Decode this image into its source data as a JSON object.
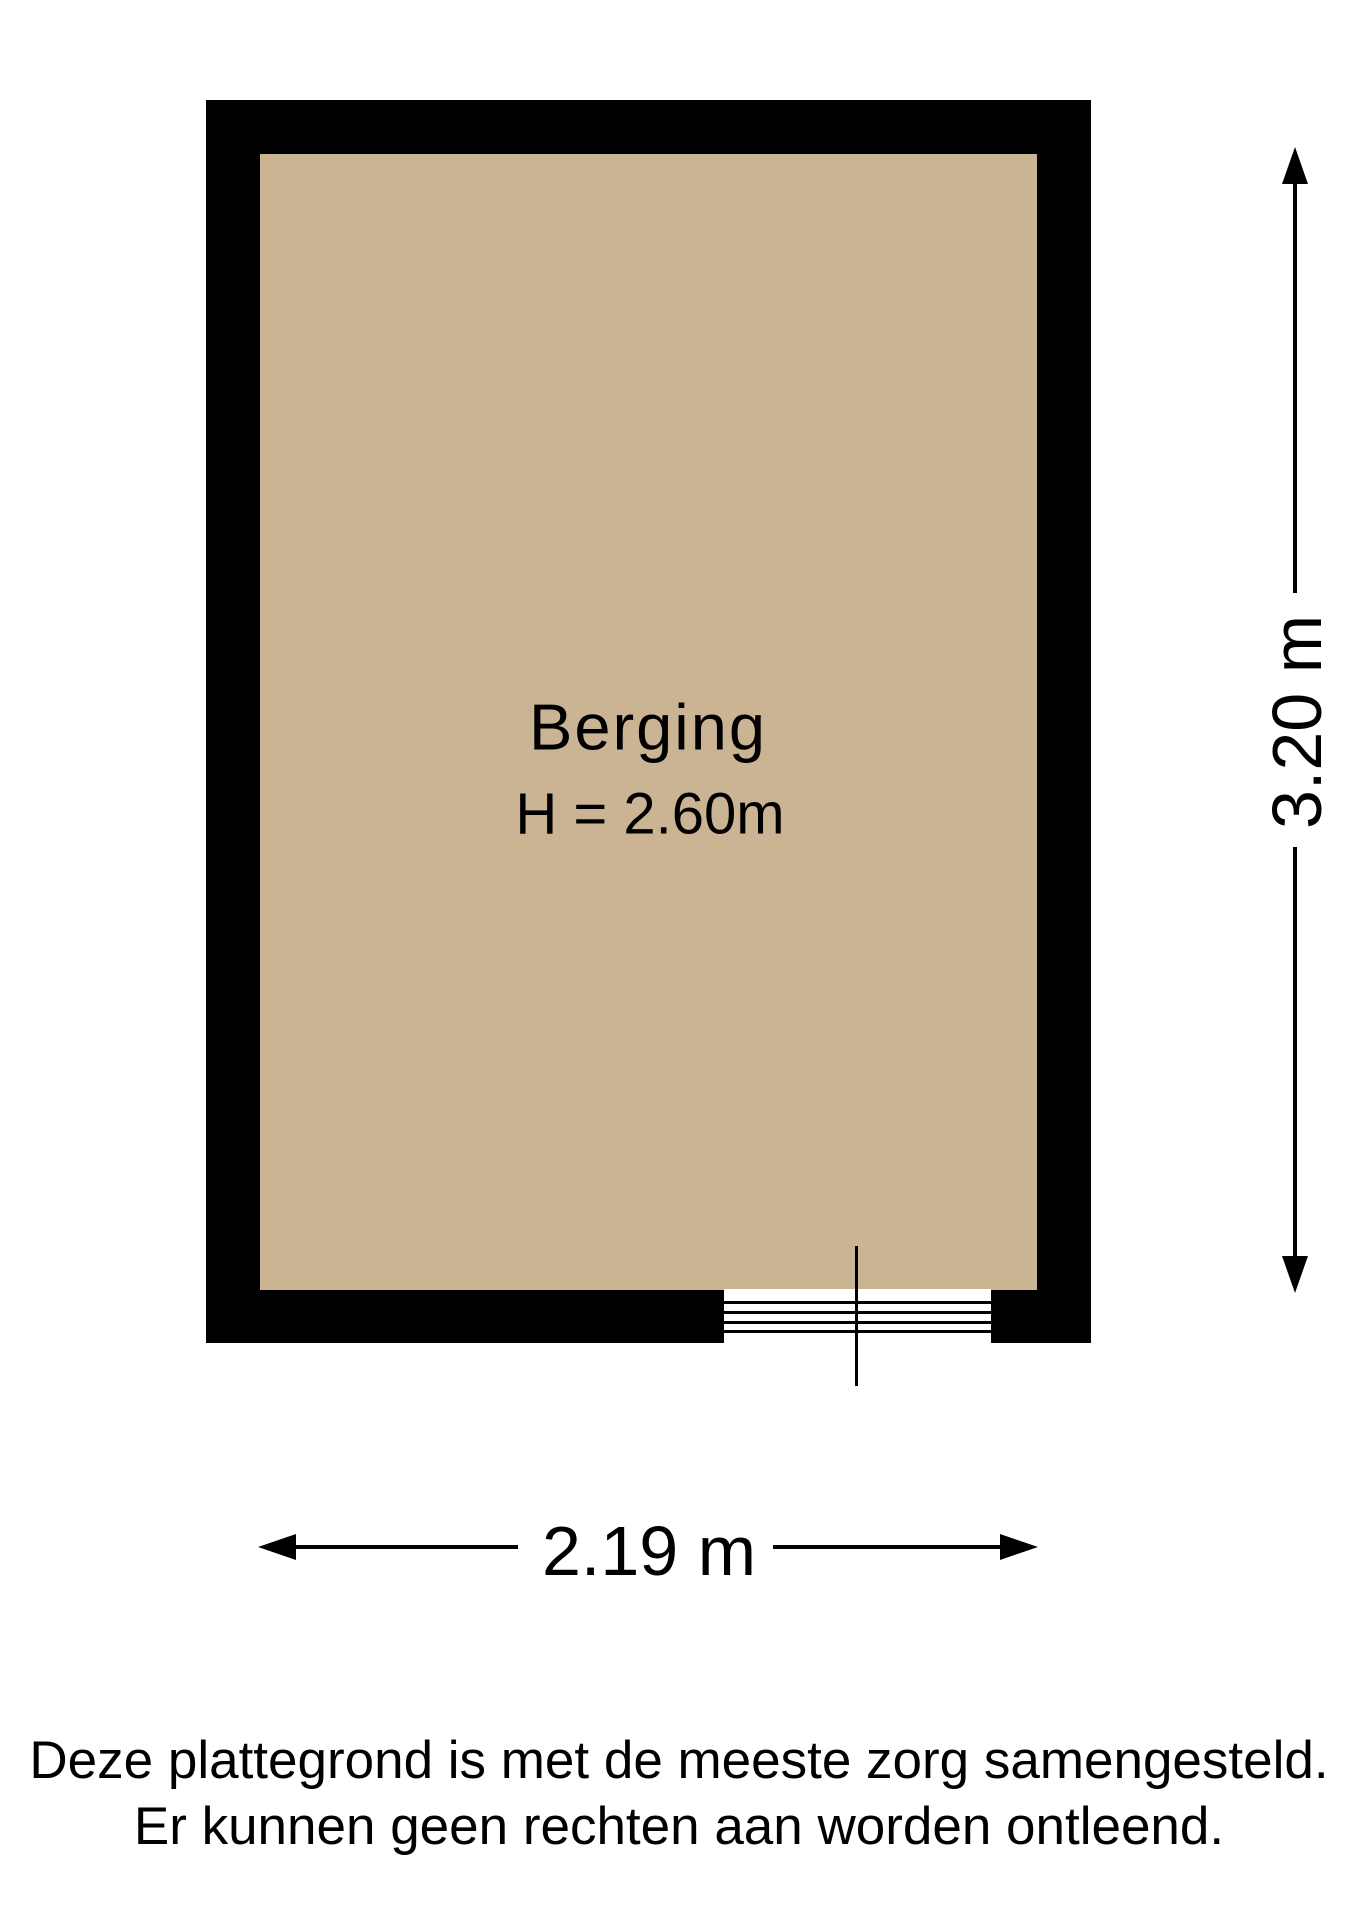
{
  "floorplan": {
    "room": {
      "name": "Berging",
      "ceiling_height_label": "H = 2.60m",
      "floor_color": "#cbb494",
      "wall_color": "#000000"
    },
    "dimensions": {
      "width_label": "2.19 m",
      "height_label": "3.20 m"
    },
    "disclaimer": {
      "line1": "Deze plattegrond is met de meeste zorg samengesteld.",
      "line2": "Er kunnen geen rechten aan worden ontleend."
    }
  }
}
